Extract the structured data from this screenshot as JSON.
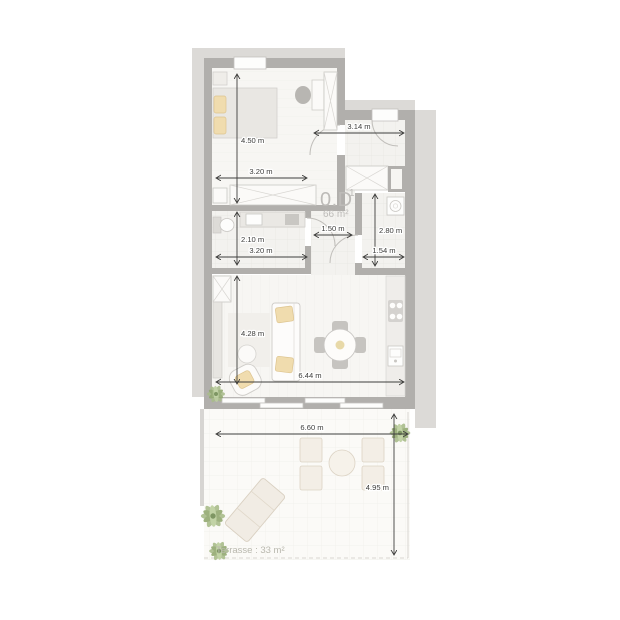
{
  "unit": {
    "code": "0.D",
    "superscript": "1",
    "area": "66 m²"
  },
  "terrace": {
    "label": "Terrasse : 33 m²"
  },
  "dimensions": {
    "bedroom_height": "4.50 m",
    "bedroom_width": "3.20 m",
    "entry_width": "3.14 m",
    "shower_height": "2.10 m",
    "shower_width": "3.20 m",
    "hall_width": "1.50 m",
    "bathroom_height": "2.80 m",
    "bathroom_width": "1.54 m",
    "living_height": "4.28 m",
    "living_width": "6.44 m",
    "terrace_width": "6.60 m",
    "terrace_height": "4.95 m"
  },
  "colors": {
    "wall": "#b1afac",
    "neighbor_mass": "#dcdad7",
    "floor": "#f7f6f3",
    "wet_room_floor": "#f3f2ef",
    "terrace_floor": "#fbfaf7",
    "cushion_accent": "#f0dcae",
    "plant_green": "#a9bc8b",
    "dimension_ink": "#3e3e3c",
    "unit_label_gray": "#bdbbb8"
  }
}
